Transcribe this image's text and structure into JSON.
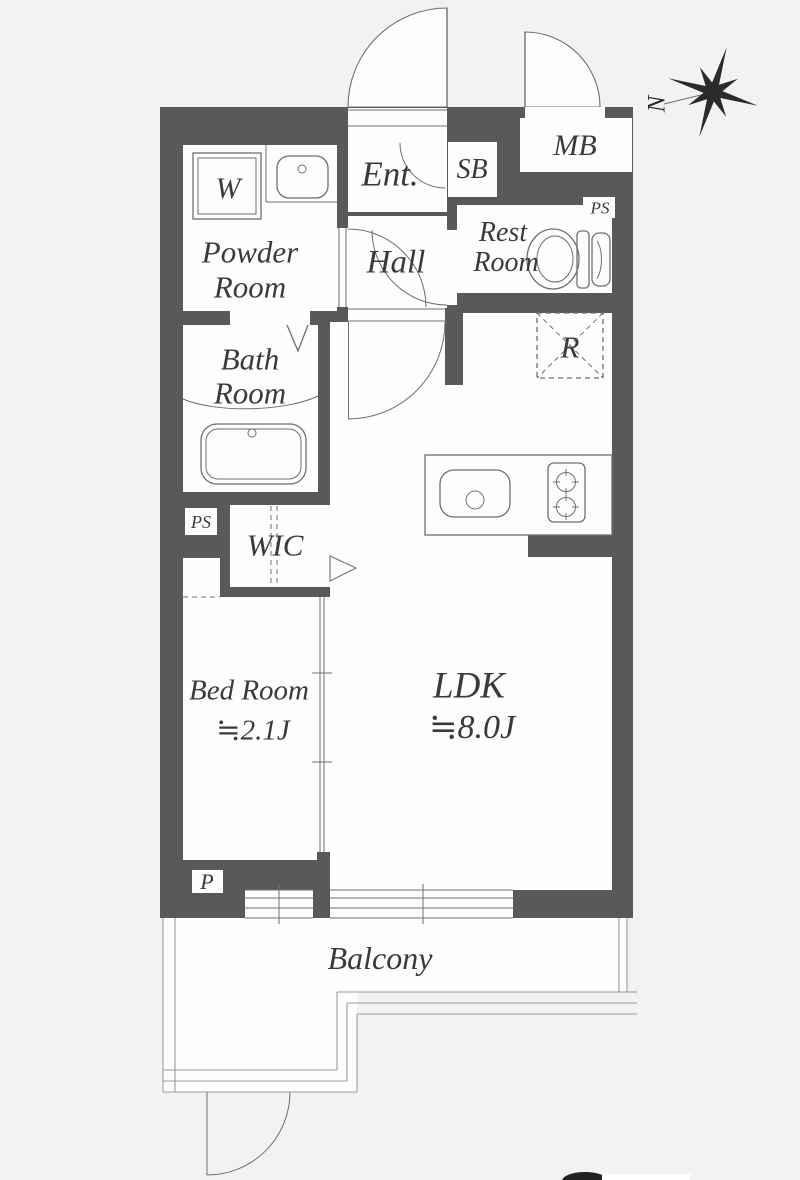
{
  "title": "1K apartment floor plan",
  "colors": {
    "background": "#f2f2f2",
    "wall": "#595959",
    "room": "#fdfdfd",
    "line": "#6f6f6f",
    "text": "#3a3a3a"
  },
  "labels": {
    "powder_line1": "Powder",
    "powder_line2": "Room",
    "washer": "W",
    "ent": "Ent.",
    "sb": "SB",
    "mb": "MB",
    "hall": "Hall",
    "rest_line1": "Rest",
    "rest_line2": "Room",
    "ps_top": "PS",
    "bath_line1": "Bath",
    "bath_line2": "Room",
    "ps_left": "PS",
    "wic": "WIC",
    "fridge": "R",
    "bedroom_name": "Bed Room",
    "bedroom_size": "≒2.1J",
    "ldk_name": "LDK",
    "ldk_size": "≒8.0J",
    "parking": "P",
    "balcony": "Balcony",
    "compass_north": "N"
  }
}
